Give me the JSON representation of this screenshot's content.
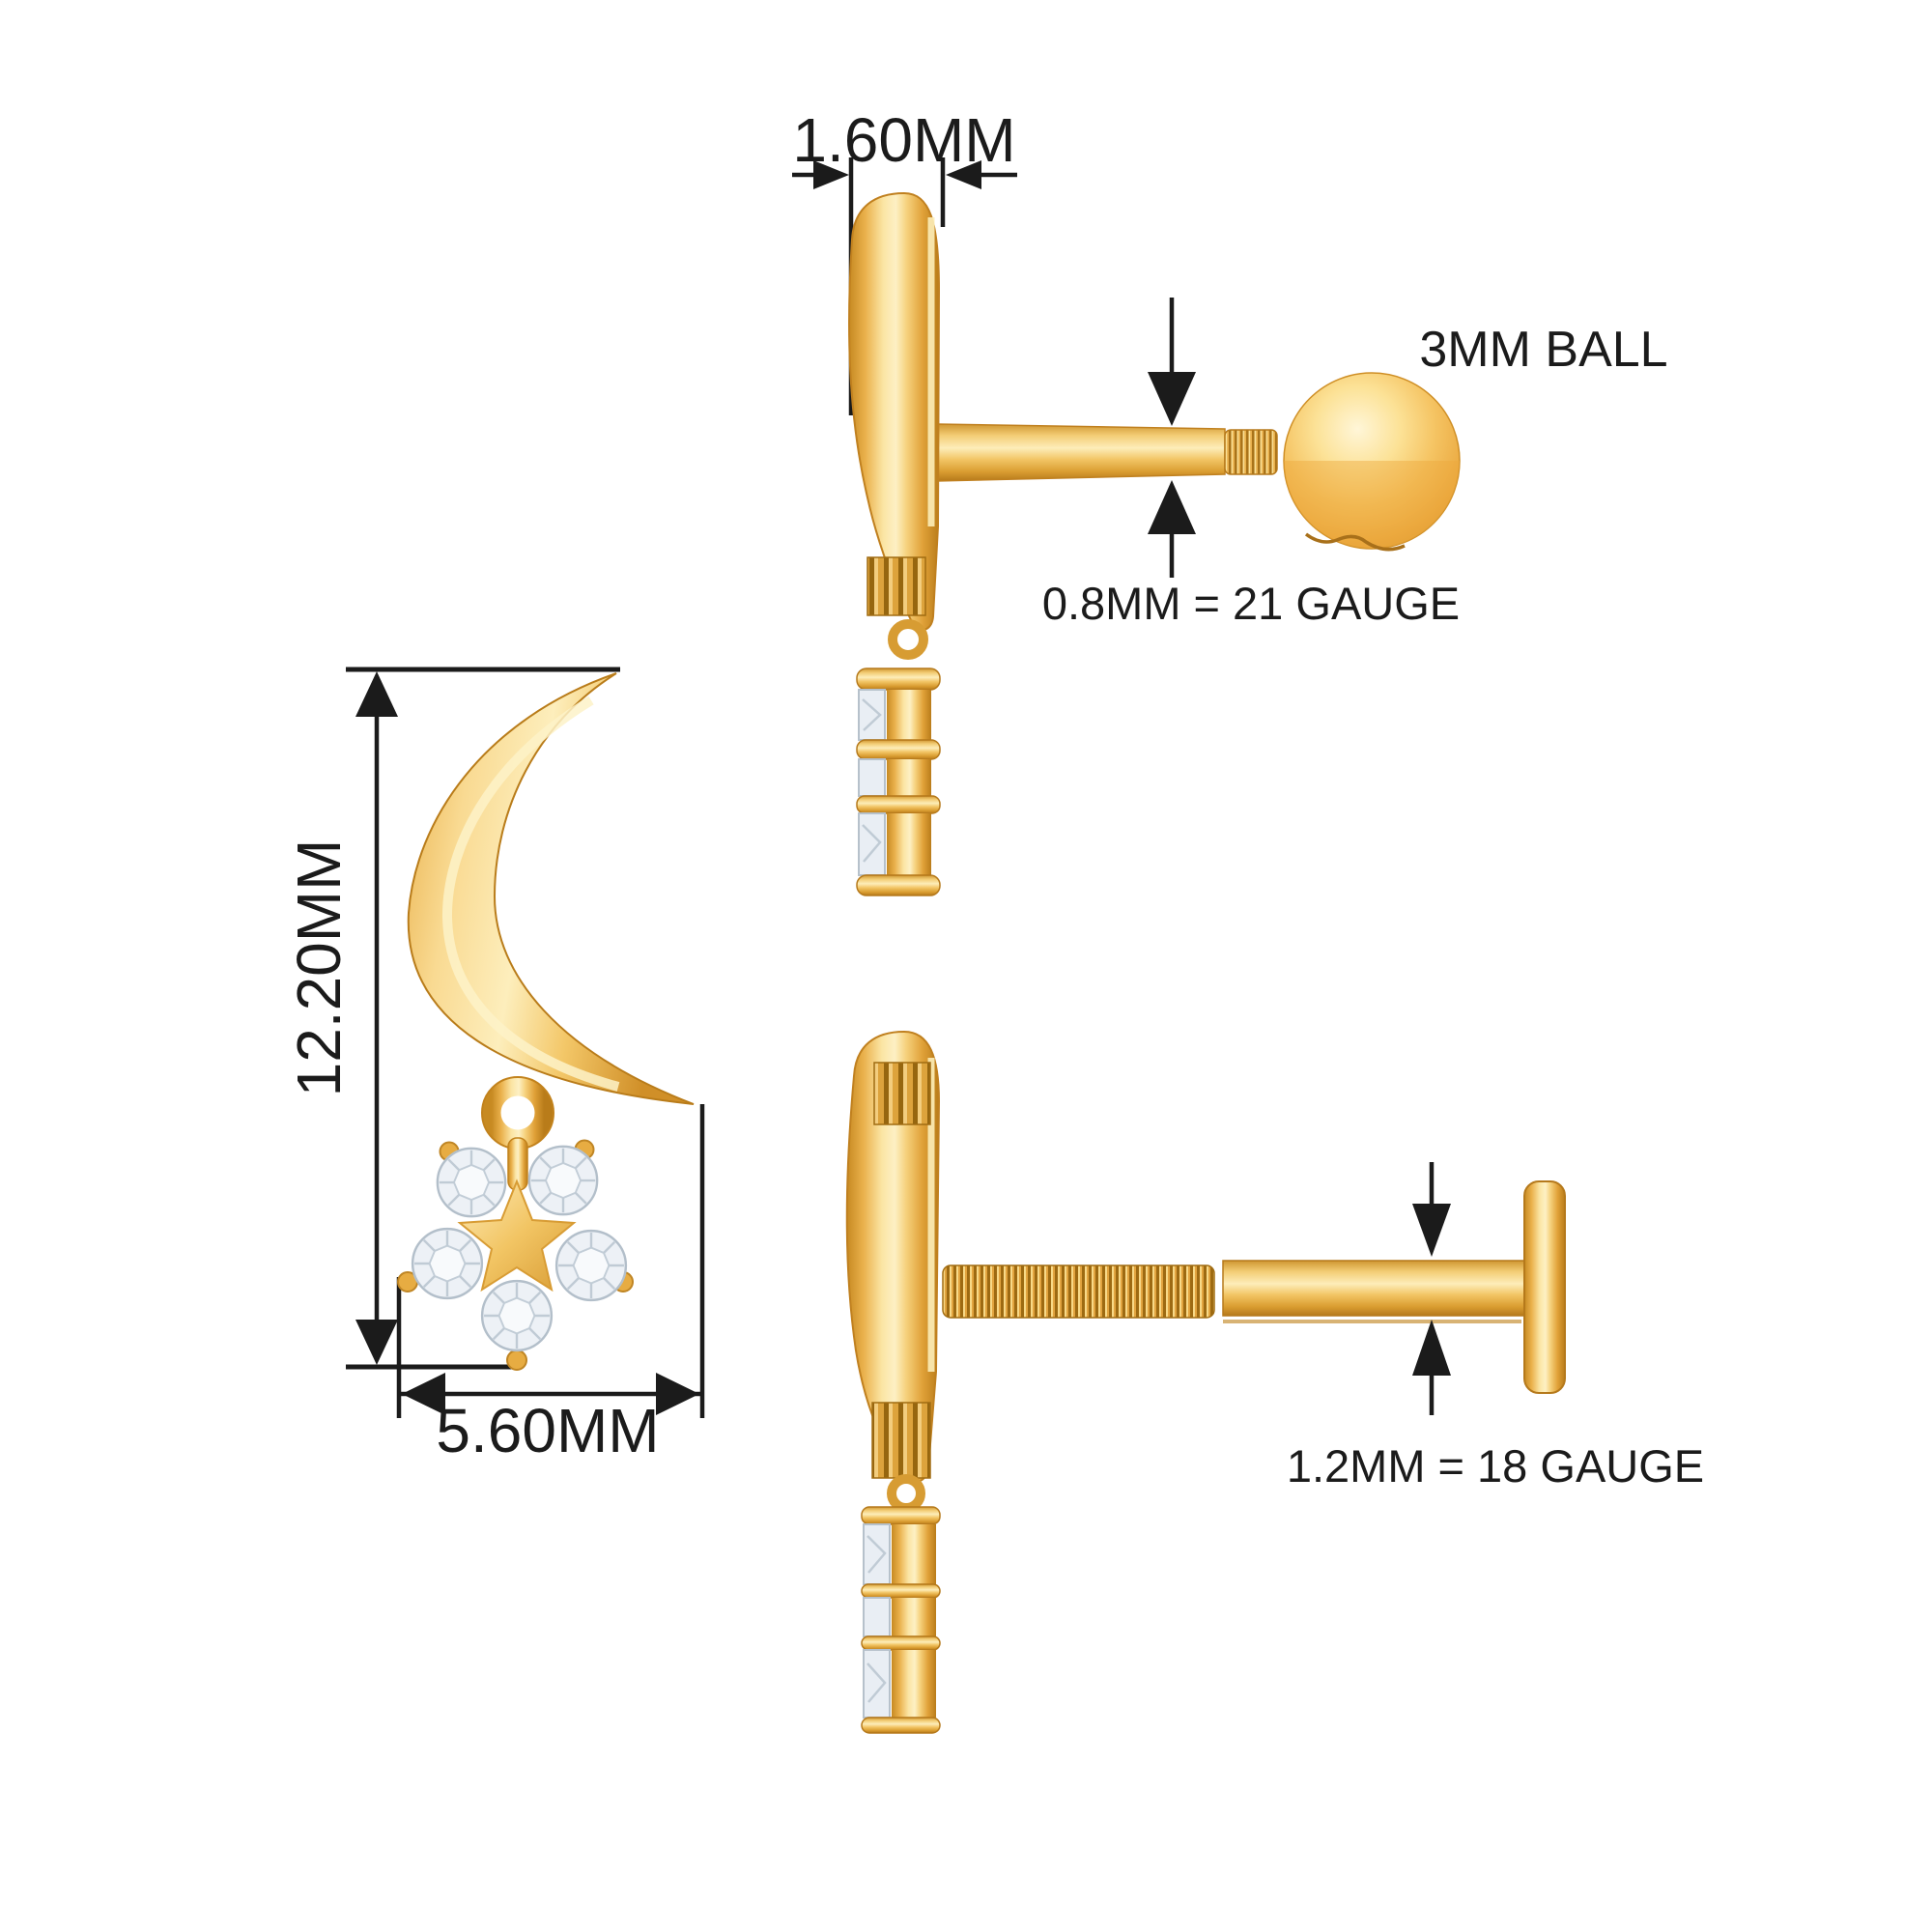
{
  "labels": {
    "thickness": "1.60MM",
    "height": "12.20MM",
    "width": "5.60MM",
    "ball": "3MM BALL",
    "post_gauge": "0.8MM = 21 GAUGE",
    "rod_gauge": "1.2MM = 18 GAUGE"
  },
  "colors": {
    "background": "#ffffff",
    "dimension_lines": "#1b1b1b",
    "gold_highlight": "#fdf0c4",
    "gold_light": "#f9da92",
    "gold_mid": "#eab14c",
    "gold_dark": "#b97c1a",
    "diamond_fill": "#edf1f6",
    "diamond_facets": "#b6c1cb"
  }
}
